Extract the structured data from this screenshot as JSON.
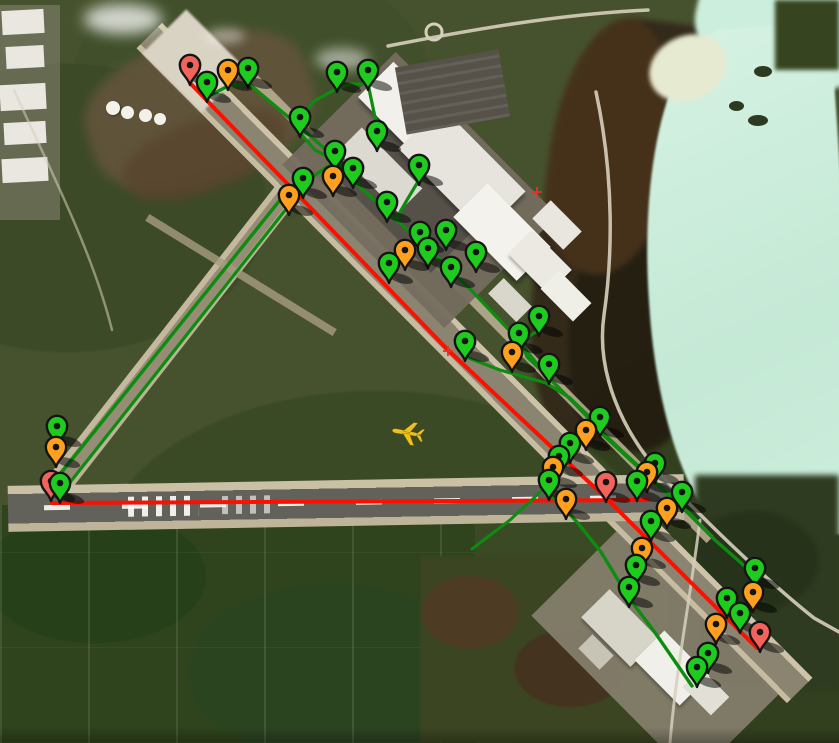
{
  "map": {
    "type": "satellite-airport-view",
    "colors": {
      "marker_green": "#1ecc1e",
      "marker_orange": "#ffa01e",
      "marker_red": "#f2635c",
      "route_red": "#fe1000",
      "route_green": "#0d8c10",
      "plane": "#eec11d",
      "crosshair": "#e03528",
      "pin_outline": "#141414"
    }
  },
  "annotations": {
    "markers": [
      {
        "x": 190,
        "y": 65,
        "color": "red"
      },
      {
        "x": 207,
        "y": 82,
        "color": "green"
      },
      {
        "x": 228,
        "y": 70,
        "color": "orange"
      },
      {
        "x": 248,
        "y": 68,
        "color": "green"
      },
      {
        "x": 337,
        "y": 72,
        "color": "green"
      },
      {
        "x": 368,
        "y": 70,
        "color": "green"
      },
      {
        "x": 300,
        "y": 117,
        "color": "green"
      },
      {
        "x": 377,
        "y": 131,
        "color": "green"
      },
      {
        "x": 335,
        "y": 151,
        "color": "green"
      },
      {
        "x": 353,
        "y": 168,
        "color": "green"
      },
      {
        "x": 333,
        "y": 176,
        "color": "orange"
      },
      {
        "x": 303,
        "y": 178,
        "color": "green"
      },
      {
        "x": 289,
        "y": 195,
        "color": "orange"
      },
      {
        "x": 419,
        "y": 165,
        "color": "green"
      },
      {
        "x": 387,
        "y": 202,
        "color": "green"
      },
      {
        "x": 420,
        "y": 232,
        "color": "green"
      },
      {
        "x": 446,
        "y": 230,
        "color": "green"
      },
      {
        "x": 428,
        "y": 248,
        "color": "green"
      },
      {
        "x": 405,
        "y": 250,
        "color": "orange"
      },
      {
        "x": 389,
        "y": 263,
        "color": "green"
      },
      {
        "x": 476,
        "y": 252,
        "color": "green"
      },
      {
        "x": 451,
        "y": 267,
        "color": "green"
      },
      {
        "x": 465,
        "y": 341,
        "color": "green"
      },
      {
        "x": 519,
        "y": 333,
        "color": "green"
      },
      {
        "x": 539,
        "y": 316,
        "color": "green"
      },
      {
        "x": 512,
        "y": 352,
        "color": "orange"
      },
      {
        "x": 549,
        "y": 364,
        "color": "green"
      },
      {
        "x": 57,
        "y": 426,
        "color": "green"
      },
      {
        "x": 56,
        "y": 447,
        "color": "orange"
      },
      {
        "x": 51,
        "y": 481,
        "color": "red"
      },
      {
        "x": 60,
        "y": 483,
        "color": "green"
      },
      {
        "x": 600,
        "y": 417,
        "color": "green"
      },
      {
        "x": 586,
        "y": 430,
        "color": "orange"
      },
      {
        "x": 570,
        "y": 443,
        "color": "green"
      },
      {
        "x": 559,
        "y": 456,
        "color": "green"
      },
      {
        "x": 553,
        "y": 467,
        "color": "orange"
      },
      {
        "x": 549,
        "y": 480,
        "color": "green"
      },
      {
        "x": 566,
        "y": 499,
        "color": "orange"
      },
      {
        "x": 606,
        "y": 482,
        "color": "red"
      },
      {
        "x": 655,
        "y": 463,
        "color": "green"
      },
      {
        "x": 647,
        "y": 472,
        "color": "orange"
      },
      {
        "x": 637,
        "y": 481,
        "color": "green"
      },
      {
        "x": 682,
        "y": 492,
        "color": "green"
      },
      {
        "x": 667,
        "y": 508,
        "color": "orange"
      },
      {
        "x": 651,
        "y": 521,
        "color": "green"
      },
      {
        "x": 642,
        "y": 548,
        "color": "orange"
      },
      {
        "x": 636,
        "y": 565,
        "color": "green"
      },
      {
        "x": 629,
        "y": 587,
        "color": "green"
      },
      {
        "x": 755,
        "y": 568,
        "color": "green"
      },
      {
        "x": 753,
        "y": 592,
        "color": "orange"
      },
      {
        "x": 727,
        "y": 598,
        "color": "green"
      },
      {
        "x": 740,
        "y": 613,
        "color": "green"
      },
      {
        "x": 716,
        "y": 624,
        "color": "orange"
      },
      {
        "x": 760,
        "y": 632,
        "color": "red"
      },
      {
        "x": 708,
        "y": 653,
        "color": "green"
      },
      {
        "x": 697,
        "y": 667,
        "color": "green"
      }
    ],
    "routes": [
      {
        "color": "red",
        "width": 4,
        "id": "route-main-runway",
        "points": [
          [
            190,
            83
          ],
          [
            448,
            350
          ],
          [
            607,
            499
          ],
          [
            757,
            648
          ]
        ]
      },
      {
        "color": "red",
        "width": 4,
        "id": "route-runway-09-27",
        "points": [
          [
            52,
            503
          ],
          [
            648,
            500
          ]
        ]
      },
      {
        "color": "green",
        "width": 3.4,
        "id": "route-nw-runway-1",
        "points": [
          [
            57,
            478
          ],
          [
            288,
            190
          ]
        ]
      },
      {
        "color": "green",
        "width": 3.2,
        "id": "route-nw-runway-2",
        "points": [
          [
            64,
            490
          ],
          [
            294,
            199
          ]
        ]
      },
      {
        "color": "green",
        "width": 3.2,
        "id": "route-junction",
        "points": [
          [
            293,
            197
          ],
          [
            312,
            177
          ],
          [
            333,
            163
          ],
          [
            352,
            171
          ],
          [
            360,
            186
          ]
        ]
      },
      {
        "color": "green",
        "width": 3.4,
        "id": "route-taxiway-main",
        "points": [
          [
            207,
            97
          ],
          [
            228,
            86
          ],
          [
            249,
            84
          ],
          [
            299,
            126
          ],
          [
            340,
            162
          ],
          [
            359,
            186
          ],
          [
            392,
            216
          ],
          [
            432,
            252
          ],
          [
            470,
            289
          ],
          [
            509,
            330
          ],
          [
            548,
            377
          ],
          [
            575,
            404
          ],
          [
            600,
            430
          ],
          [
            622,
            451
          ],
          [
            645,
            472
          ],
          [
            665,
            492
          ],
          [
            690,
            515
          ],
          [
            715,
            540
          ],
          [
            740,
            562
          ],
          [
            757,
            578
          ]
        ]
      },
      {
        "color": "green",
        "width": 3.2,
        "id": "route-apron-top-a",
        "points": [
          [
            338,
            88
          ],
          [
            352,
            84
          ],
          [
            368,
            84
          ]
        ]
      },
      {
        "color": "green",
        "width": 3.2,
        "id": "route-apron-top-b",
        "points": [
          [
            368,
            84
          ],
          [
            376,
            122
          ],
          [
            377,
            146
          ]
        ]
      },
      {
        "color": "green",
        "width": 3.2,
        "id": "route-apron-top-c",
        "points": [
          [
            338,
            88
          ],
          [
            314,
            101
          ],
          [
            301,
            119
          ],
          [
            301,
            134
          ],
          [
            315,
            150
          ],
          [
            338,
            162
          ]
        ]
      },
      {
        "color": "green",
        "width": 3.2,
        "id": "route-terminal-spur",
        "points": [
          [
            419,
            180
          ],
          [
            407,
            200
          ],
          [
            396,
            219
          ]
        ]
      },
      {
        "color": "green",
        "width": 3.2,
        "id": "route-loop",
        "points": [
          [
            539,
            330
          ],
          [
            521,
            341
          ],
          [
            527,
            357
          ],
          [
            545,
            374
          ]
        ]
      },
      {
        "color": "green",
        "width": 3.2,
        "id": "route-branch",
        "points": [
          [
            466,
            357
          ],
          [
            500,
            370
          ],
          [
            546,
            383
          ],
          [
            570,
            398
          ],
          [
            592,
            419
          ]
        ]
      },
      {
        "color": "green",
        "width": 3.4,
        "id": "route-southeast",
        "points": [
          [
            553,
            497
          ],
          [
            577,
            522
          ],
          [
            601,
            552
          ],
          [
            629,
            598
          ],
          [
            656,
            634
          ],
          [
            692,
            686
          ]
        ]
      },
      {
        "color": "green",
        "width": 3.2,
        "id": "route-right-column",
        "points": [
          [
            602,
            434
          ],
          [
            628,
            458
          ],
          [
            652,
            480
          ],
          [
            676,
            500
          ],
          [
            695,
            519
          ]
        ]
      },
      {
        "color": "green",
        "width": 3.0,
        "id": "route-west-spur",
        "points": [
          [
            549,
            484
          ],
          [
            510,
            520
          ],
          [
            472,
            549
          ]
        ]
      }
    ],
    "crosshairs": [
      {
        "x": 448,
        "y": 351
      },
      {
        "x": 537,
        "y": 192
      }
    ],
    "plane": {
      "x": 408,
      "y": 433,
      "rotation": 10
    }
  }
}
